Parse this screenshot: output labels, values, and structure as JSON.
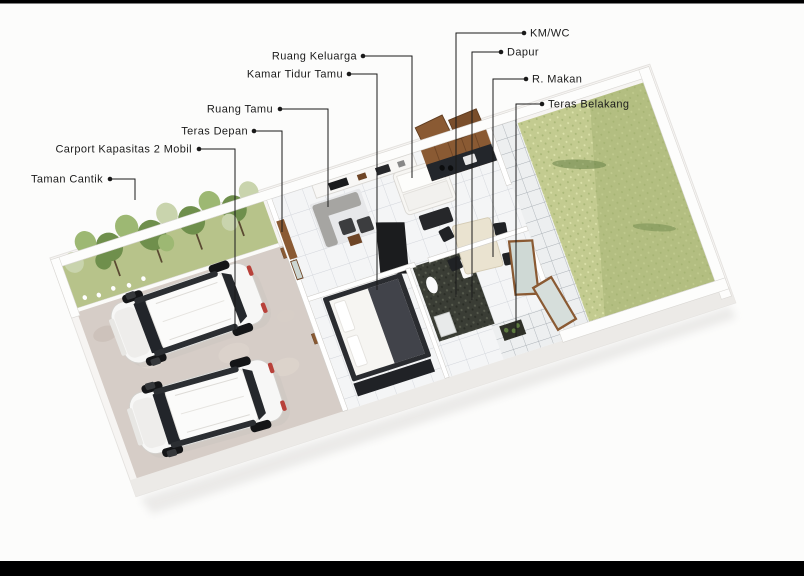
{
  "figure": {
    "type": "3d-isometric-floor-plan-rendering",
    "alt": "Denah rumah 3D: taman, carport 2 mobil, ruang-ruang interior, dan halaman rumput belakang"
  },
  "colors": {
    "page-bg": "#fcfcfb",
    "bar": "#000000",
    "line": "#1a1a1a",
    "label-text": "#1b1b1b",
    "slab": "#f6f4f2",
    "slab-side": "#eceae7",
    "floor": "#f4f5f6",
    "wall": "#ffffff",
    "wall-edge": "#d6d4d0",
    "garden-grass": "#b7c38a",
    "tree-dark": "#6f8f4c",
    "tree-mid": "#9db873",
    "tree-pale": "#c9d4ad",
    "paver": "#d6cdc7",
    "wood": "#8a5a33",
    "wood-dark": "#6e4526",
    "counter": "#23262b",
    "dark-furn": "#1b1c1e",
    "grass": "#c3cb90",
    "grass-shade": "#a3b172",
    "grass-dark": "#5d7a3f"
  },
  "labels": [
    {
      "text": "KM/WC",
      "side": "right",
      "tx": 530,
      "ty": 33,
      "bx": 524,
      "by": 33,
      "ex": 456,
      "ey": 297
    },
    {
      "text": "Dapur",
      "side": "right",
      "tx": 507,
      "ty": 52,
      "bx": 501,
      "by": 52,
      "ex": 472,
      "ey": 300
    },
    {
      "text": "R. Makan",
      "side": "right",
      "tx": 532,
      "ty": 79,
      "bx": 526,
      "by": 79,
      "ex": 493,
      "ey": 257
    },
    {
      "text": "Teras Belakang",
      "side": "right",
      "tx": 548,
      "ty": 104,
      "bx": 542,
      "by": 104,
      "ex": 516,
      "ey": 337
    },
    {
      "text": "Ruang Keluarga",
      "side": "left",
      "tx": 357,
      "ty": 56,
      "bx": 363,
      "by": 56,
      "ex": 412,
      "ey": 178
    },
    {
      "text": "Kamar Tidur Tamu",
      "side": "left",
      "tx": 343,
      "ty": 74,
      "bx": 349,
      "by": 74,
      "ex": 377,
      "ey": 290
    },
    {
      "text": "Ruang Tamu",
      "side": "left",
      "tx": 273,
      "ty": 109,
      "bx": 280,
      "by": 109,
      "ex": 328,
      "ey": 207
    },
    {
      "text": "Teras Depan",
      "side": "left",
      "tx": 248,
      "ty": 131,
      "bx": 254,
      "by": 131,
      "ex": 282,
      "ey": 232
    },
    {
      "text": "Carport Kapasitas 2 Mobil",
      "side": "left",
      "tx": 192,
      "ty": 149,
      "bx": 199,
      "by": 149,
      "ex": 235,
      "ey": 333
    },
    {
      "text": "Taman Cantik",
      "side": "left",
      "tx": 103,
      "ty": 179,
      "bx": 110,
      "by": 179,
      "ex": 135,
      "ey": 200
    }
  ]
}
